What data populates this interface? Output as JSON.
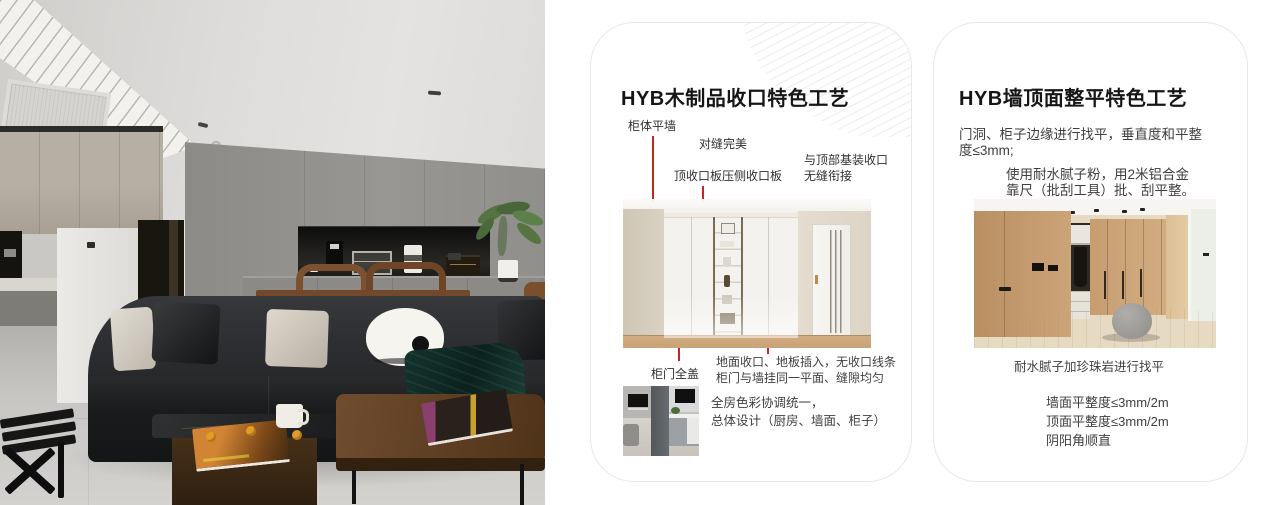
{
  "colors": {
    "accent_red": "#c3271d",
    "card_border": "#e8e8e8",
    "pattern_line": "#ececec",
    "title_text": "#161616",
    "body_text": "#3f3f3f"
  },
  "cards": [
    {
      "title": "HYB木制品收口特色工艺",
      "annotations": {
        "cabinet_flush_wall": "柜体平墙",
        "perfect_seam": "对缝完美",
        "top_closing_board": "顶收口板压侧收口板",
        "ceiling_joint_line1": "与顶部基装收口",
        "ceiling_joint_line2": "无缝衔接",
        "door_full_overlay": "柜门全盖",
        "floor_closing_line1": "地面收口、地板插入，无收口线条",
        "floor_closing_line2": "柜门与墙挂同一平面、缝隙均匀"
      },
      "summary_line1": "全房色彩协调统一，",
      "summary_line2": "总体设计（厨房、墙面、柜子）"
    },
    {
      "title": "HYB墙顶面整平特色工艺",
      "para1": "门洞、柜子边缘进行找平，垂直度和平整度≤3mm;",
      "para2_line1": "使用耐水腻子粉，用2米铝合金",
      "para2_line2": "靠尺（批刮工具）批、刮平整。",
      "photo_caption": "耐水腻子加珍珠岩进行找平",
      "bullets": [
        "墙面平整度≤3mm/2m",
        "顶面平整度≤3mm/2m",
        "阴阳角顺直"
      ]
    }
  ]
}
